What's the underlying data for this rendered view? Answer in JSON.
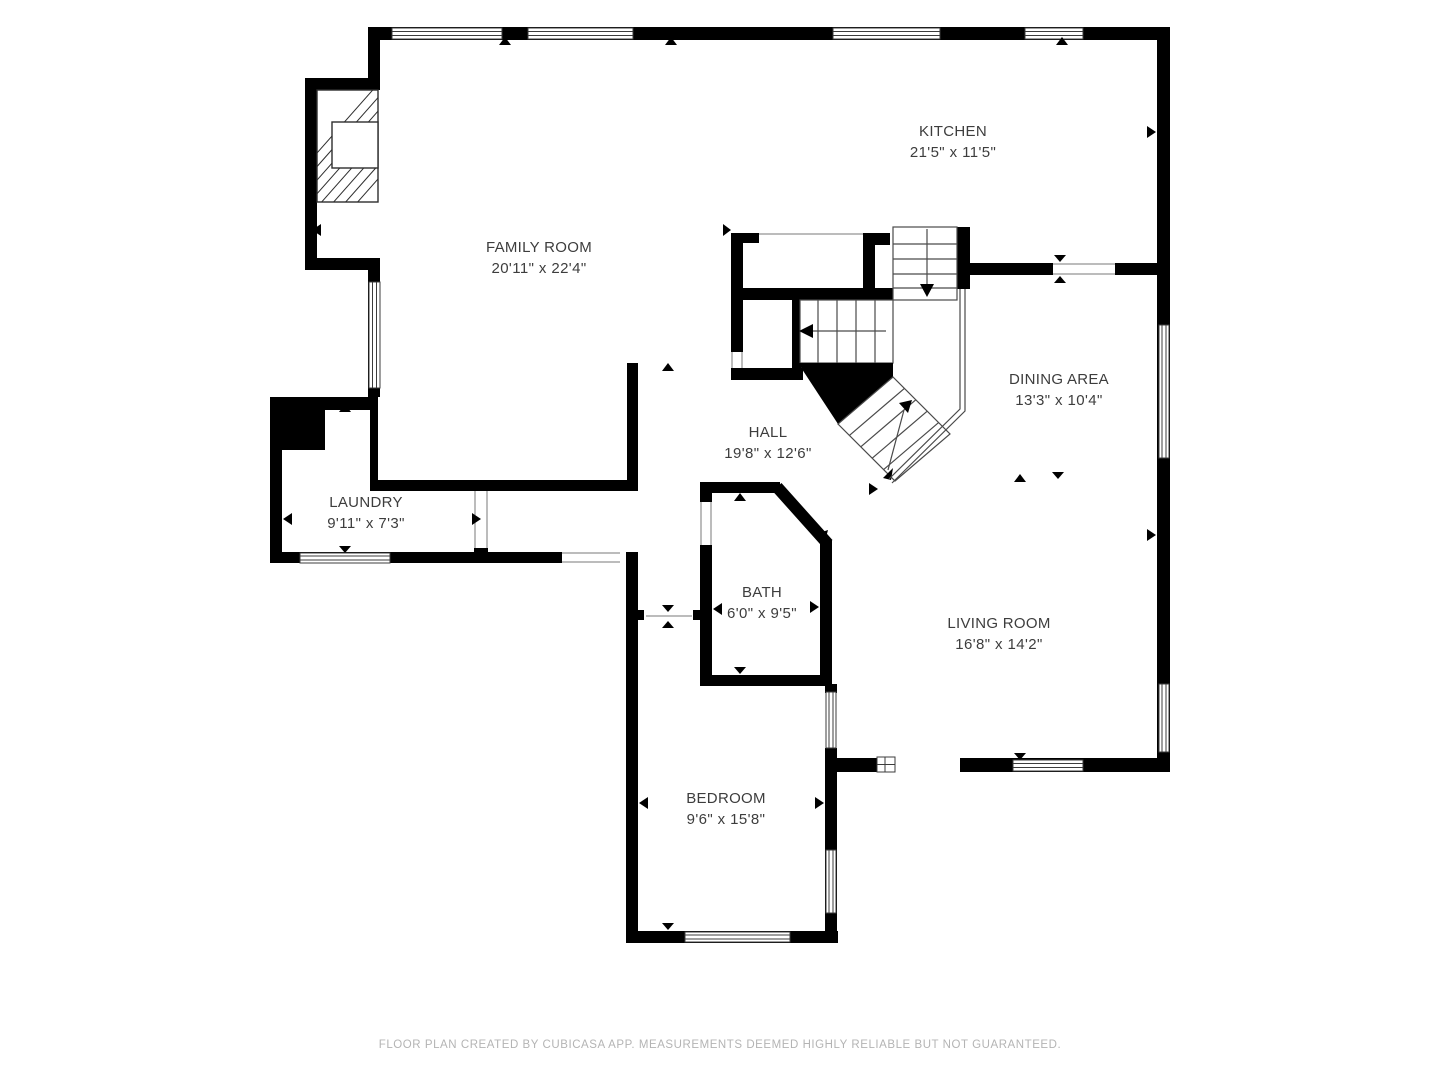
{
  "floorplan": {
    "rooms": [
      {
        "id": "family-room",
        "label": "FAMILY ROOM",
        "dimensions": "20'11\" x 22'4\""
      },
      {
        "id": "kitchen",
        "label": "KITCHEN",
        "dimensions": "21'5\" x 11'5\""
      },
      {
        "id": "dining-area",
        "label": "DINING AREA",
        "dimensions": "13'3\" x 10'4\""
      },
      {
        "id": "hall",
        "label": "HALL",
        "dimensions": "19'8\" x 12'6\""
      },
      {
        "id": "laundry",
        "label": "LAUNDRY",
        "dimensions": "9'11\" x 7'3\""
      },
      {
        "id": "bath",
        "label": "BATH",
        "dimensions": "6'0\" x 9'5\""
      },
      {
        "id": "living-room",
        "label": "LIVING ROOM",
        "dimensions": "16'8\" x 14'2\""
      },
      {
        "id": "bedroom",
        "label": "BEDROOM",
        "dimensions": "9'6\" x 15'8\""
      }
    ],
    "footer": "FLOOR PLAN CREATED BY CUBICASA APP. MEASUREMENTS DEEMED HIGHLY RELIABLE BUT NOT GUARANTEED.",
    "colors": {
      "wall": "#000000",
      "background": "#ffffff",
      "label_text": "#3d3d3d",
      "footer_text": "#b4b4b4",
      "thin_line": "#7a7a7a"
    }
  }
}
